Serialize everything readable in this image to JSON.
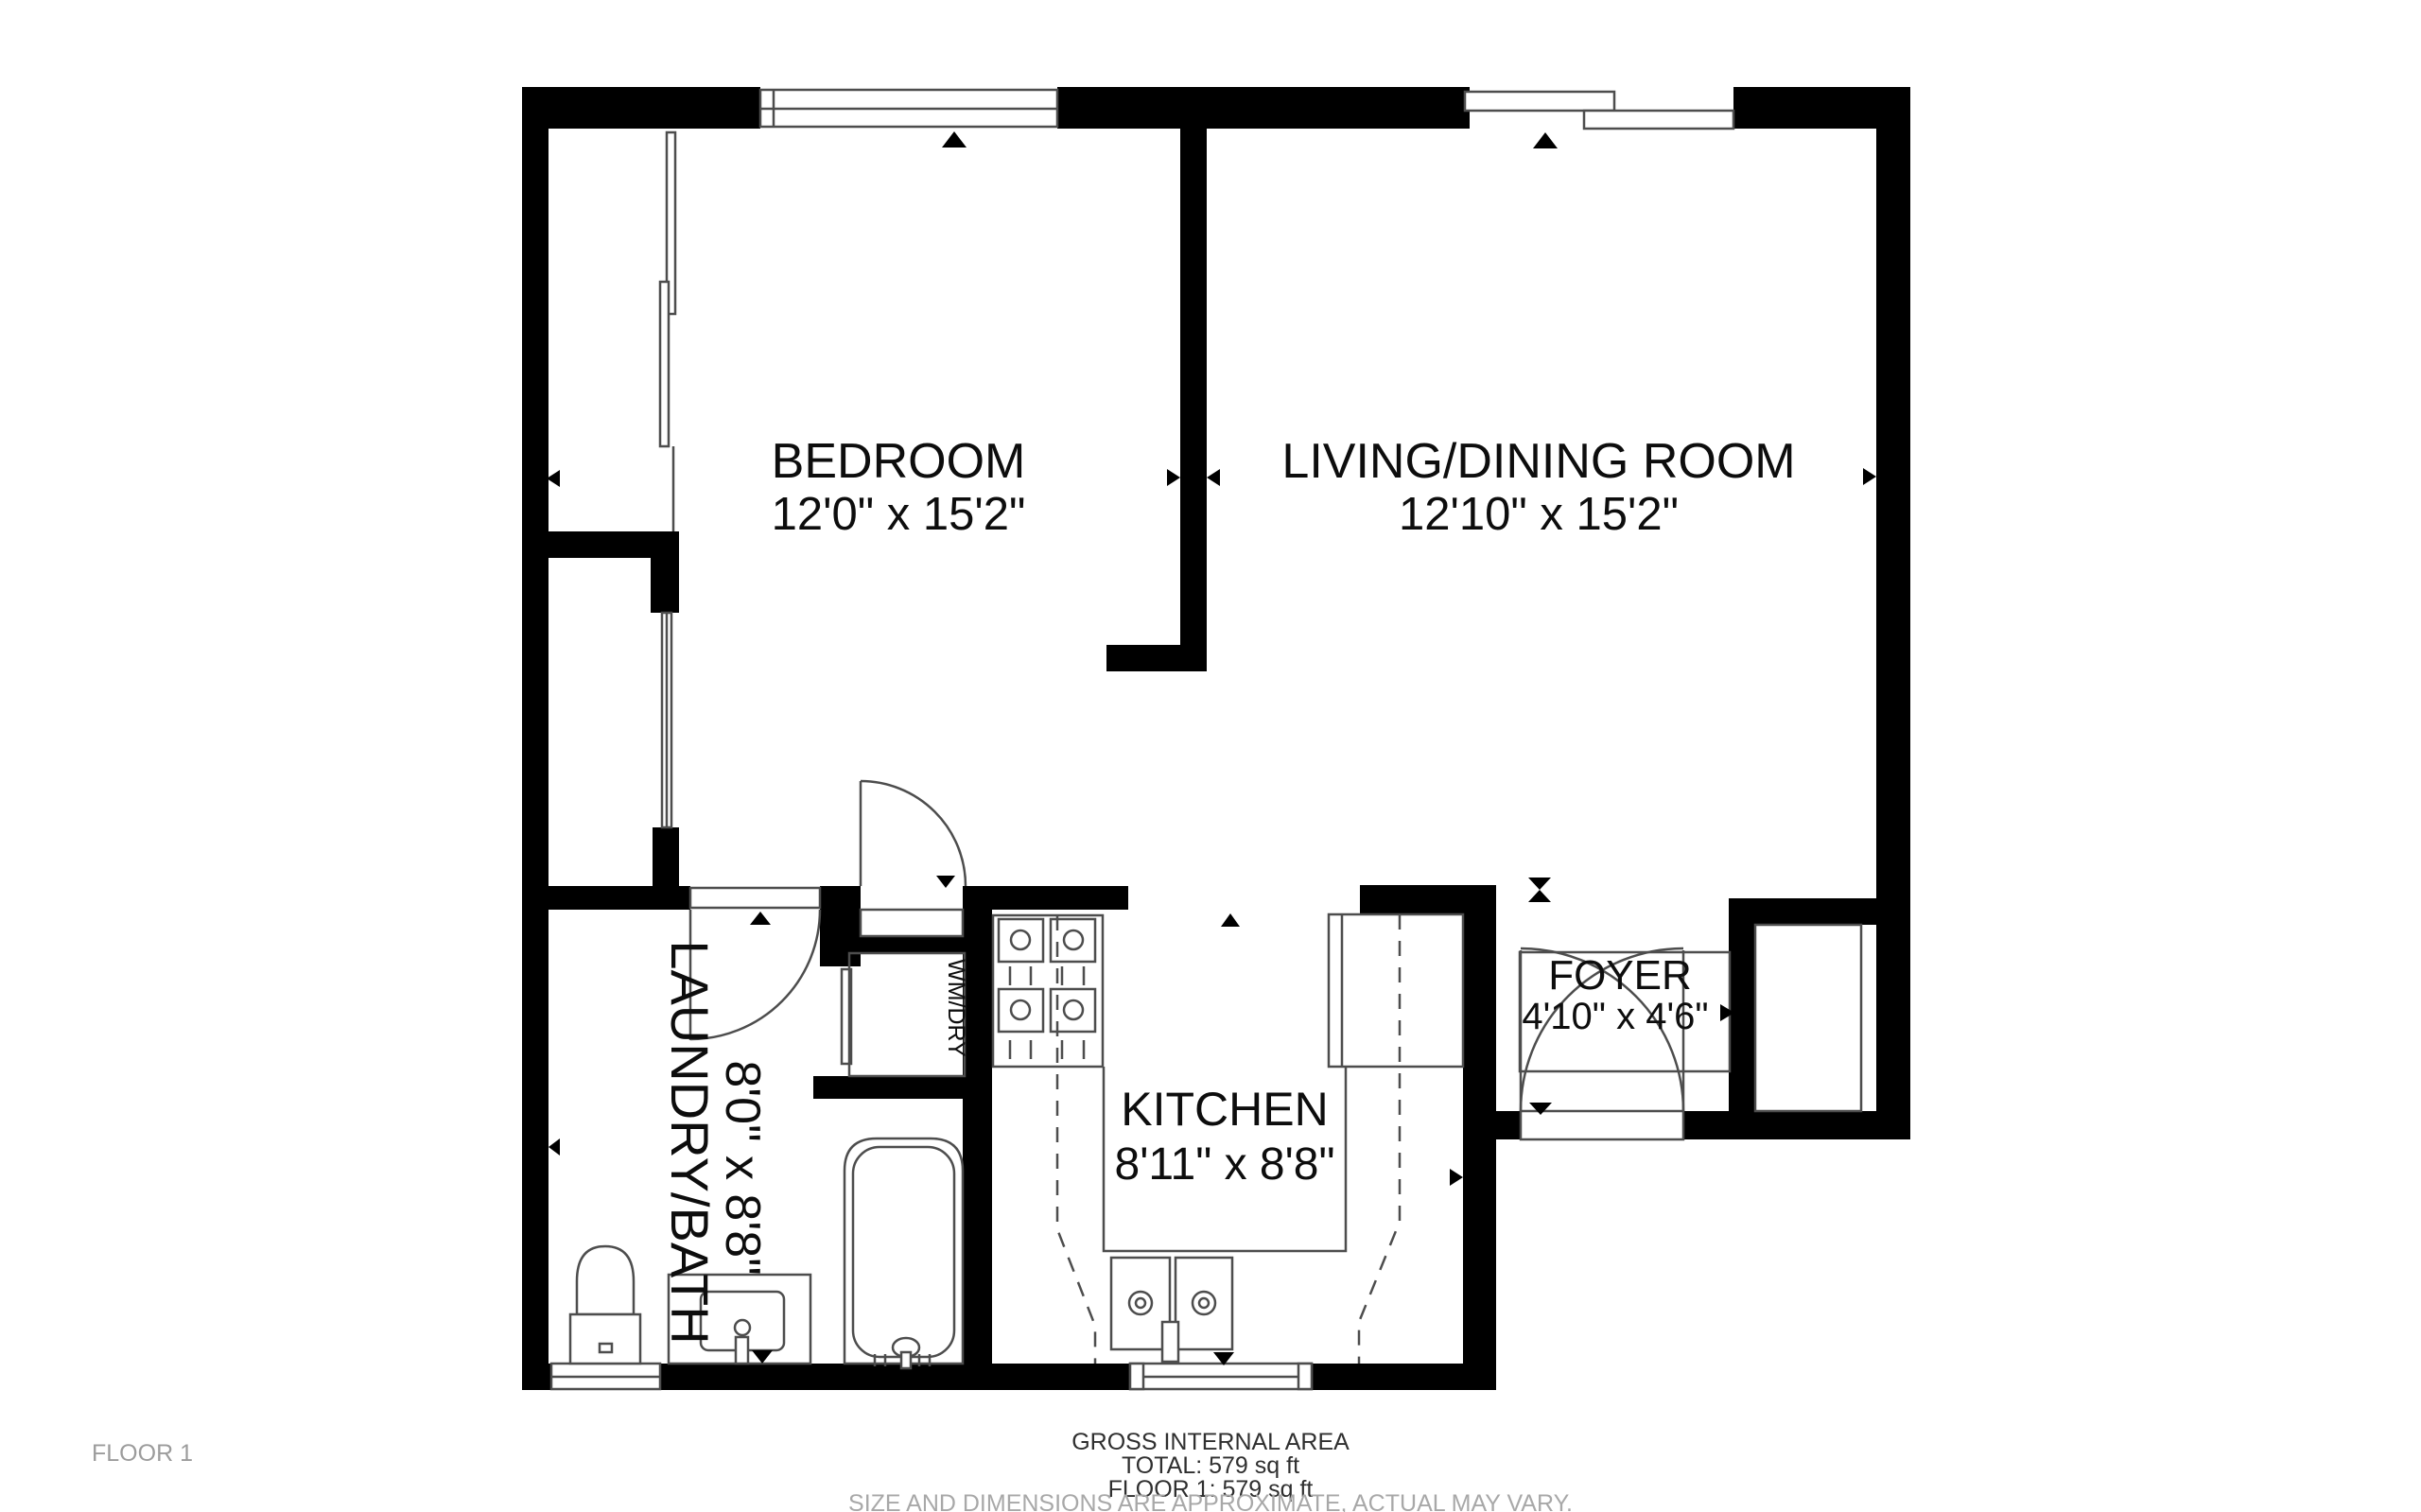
{
  "floor_label": "FLOOR 1",
  "rooms": [
    {
      "name": "BEDROOM",
      "dims": "12'0\" x 15'2\""
    },
    {
      "name": "LIVING/DINING ROOM",
      "dims": "12'10\" x 15'2\""
    },
    {
      "name": "LAUNDRY/BATH",
      "dims": "8'0\" x 8'8\""
    },
    {
      "name": "KITCHEN",
      "dims": "8'11\" x 8'8\""
    },
    {
      "name": "FOYER",
      "dims": "4'10\" x 4'6\""
    },
    {
      "name": "WM/DRY",
      "dims": ""
    }
  ],
  "summary": {
    "title": "GROSS INTERNAL AREA",
    "total": "TOTAL: 579 sq ft",
    "floor": "FLOOR 1: 579 sq ft",
    "disclaimer": "SIZE AND DIMENSIONS ARE APPROXIMATE, ACTUAL MAY VARY."
  },
  "colors": {
    "wall": "#000000",
    "line": "#4d4d4d",
    "background": "#ffffff",
    "muted_text": "#9c9c9c"
  }
}
